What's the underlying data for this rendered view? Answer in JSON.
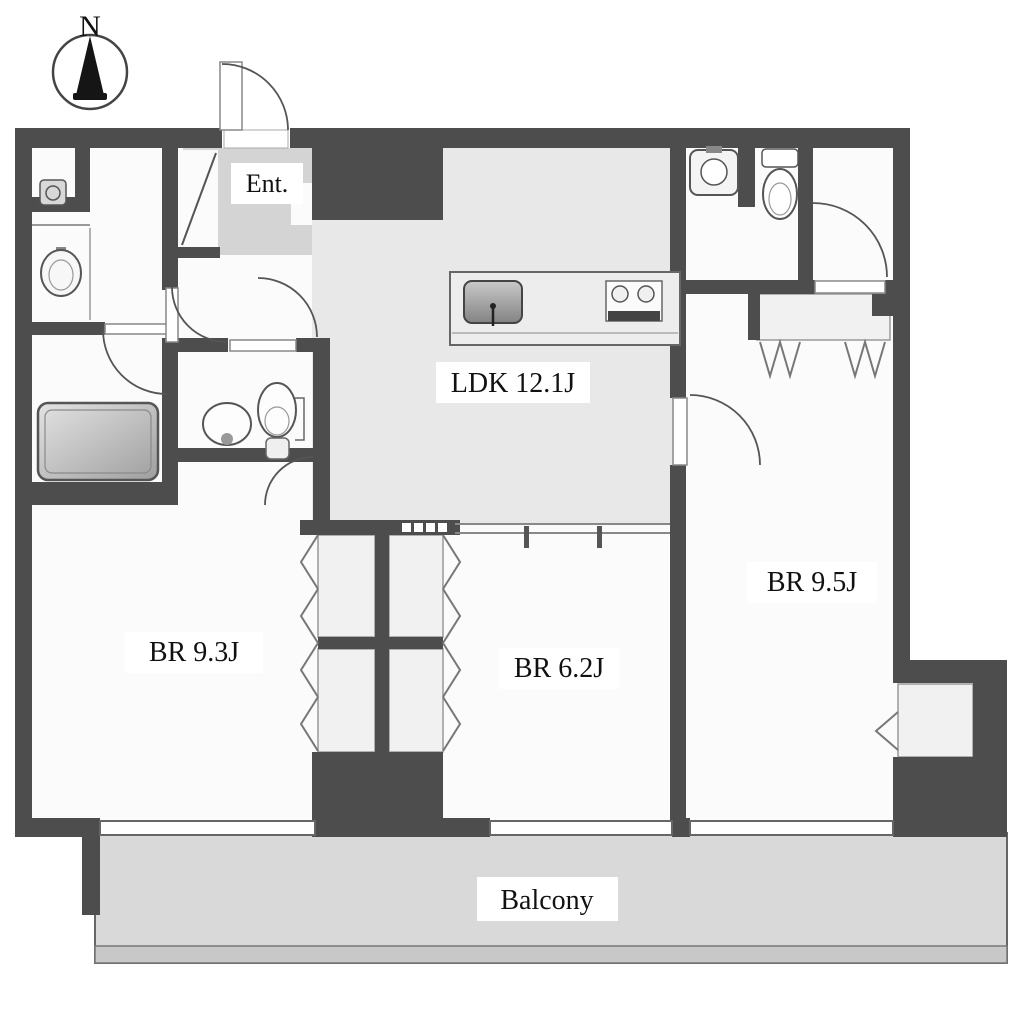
{
  "compass": {
    "north_label": "N"
  },
  "rooms": {
    "entrance": {
      "label": "Ent."
    },
    "ldk": {
      "label": "LDK 12.1J"
    },
    "bedroom1": {
      "label": "BR 9.3J"
    },
    "bedroom2": {
      "label": "BR 6.2J"
    },
    "bedroom3": {
      "label": "BR 9.5J"
    },
    "balcony": {
      "label": "Balcony"
    }
  },
  "colors": {
    "wall_color": "#4d4d4d",
    "room_floor": "#fbfbfb",
    "ldk_floor": "#e8e8e8",
    "entrance_floor": "#d4d4d4",
    "closet_floor": "#f1f1f1",
    "balcony_floor": "#d9d9d9",
    "window_fill": "#ffffff",
    "label_bg": "#ffffff",
    "label_text": "#111111",
    "fixture_stroke": "#555555",
    "arc_stroke": "#555555"
  }
}
